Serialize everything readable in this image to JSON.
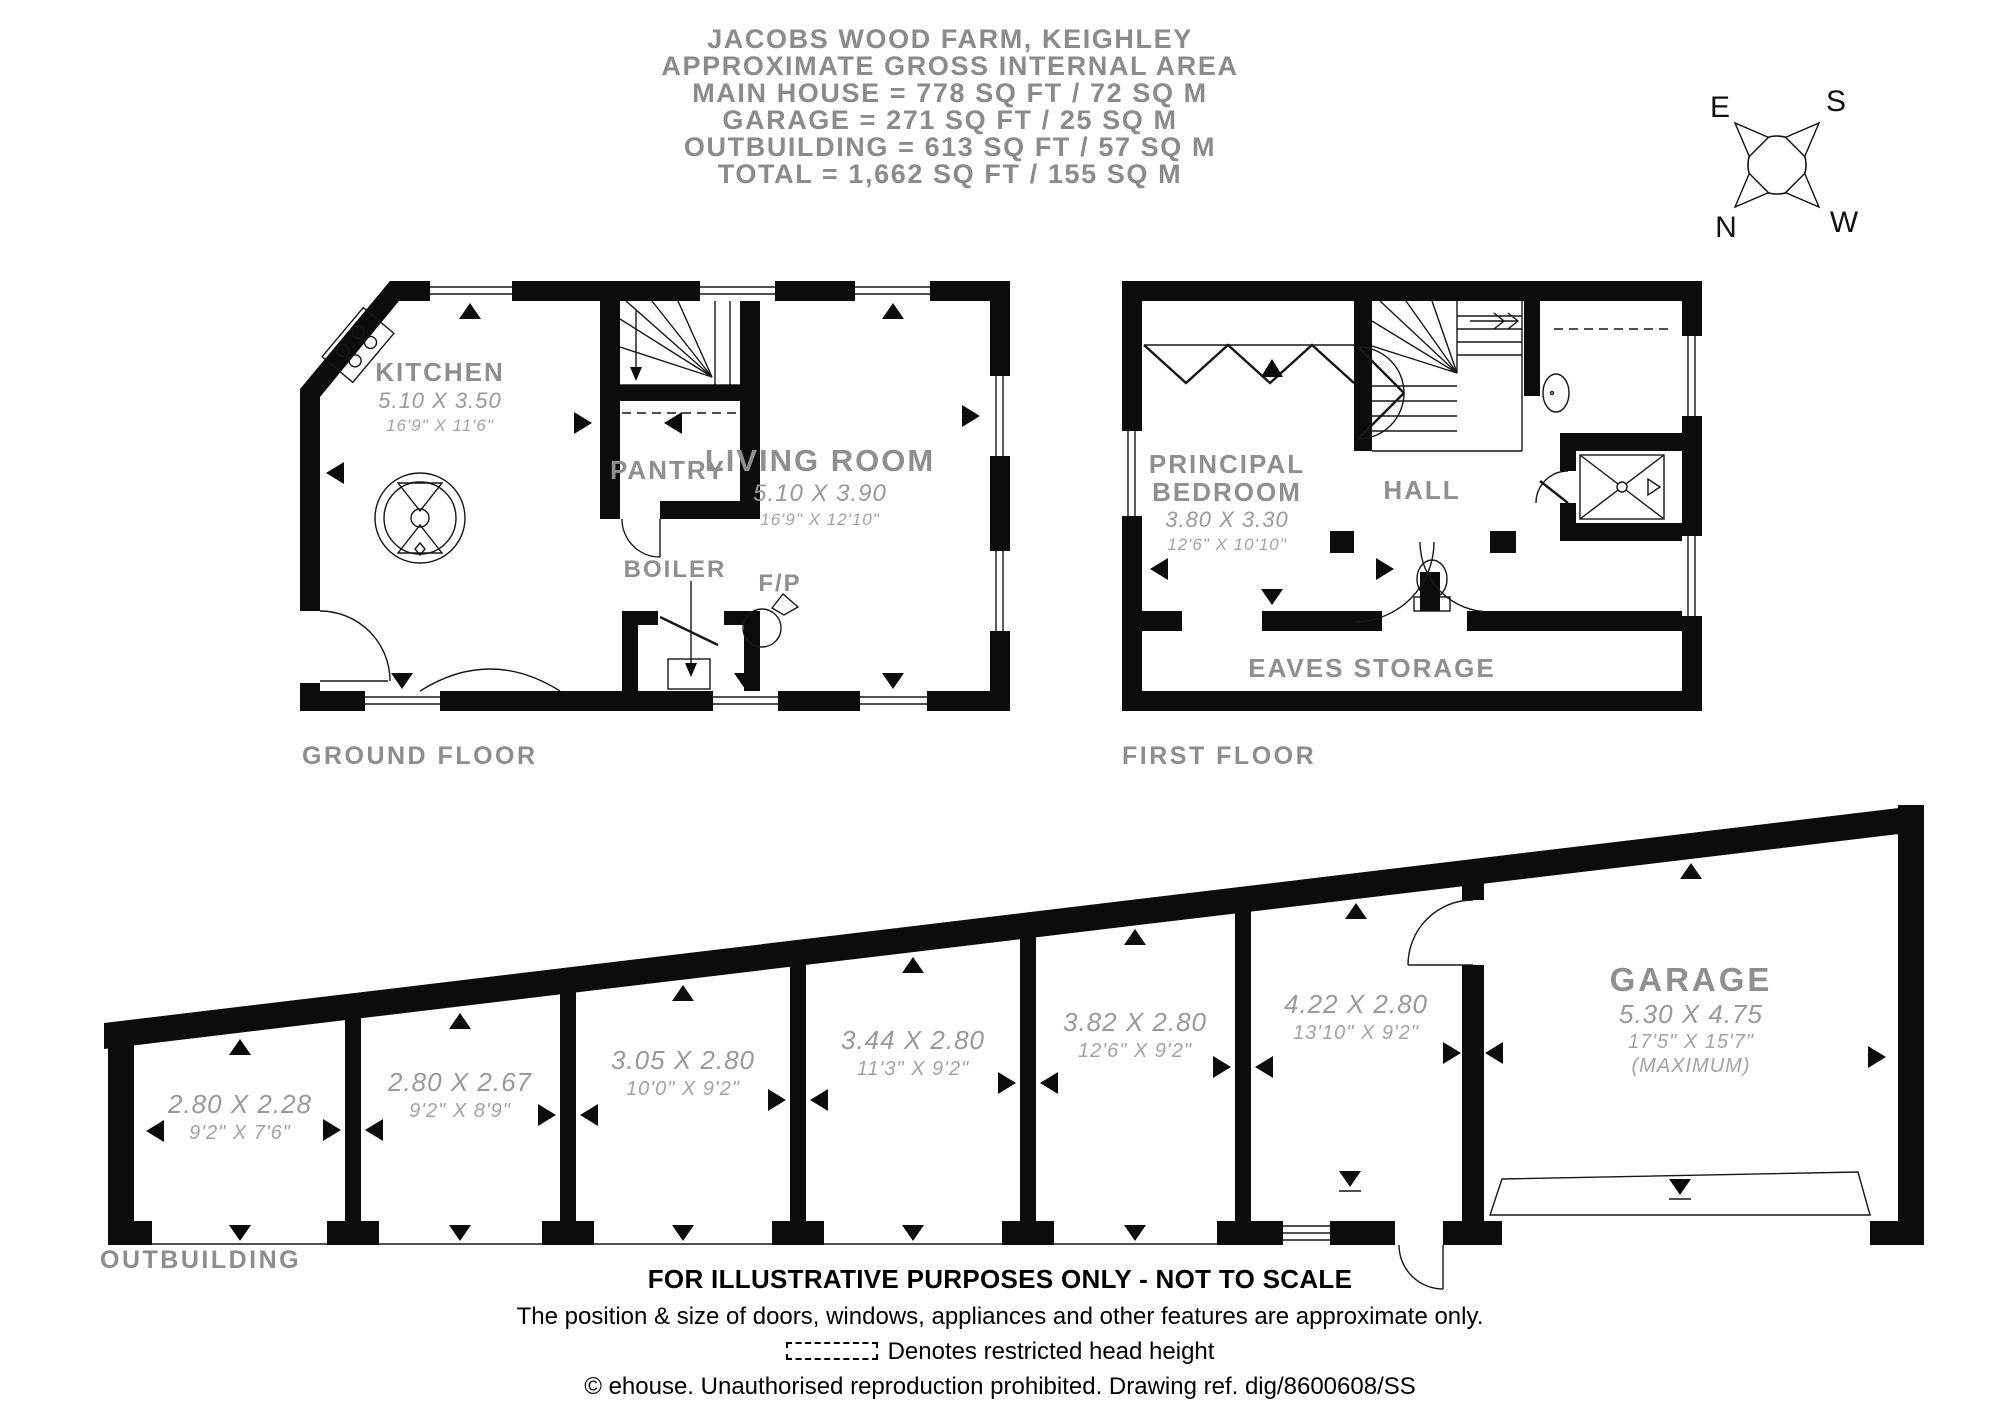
{
  "header": {
    "lines": [
      "JACOBS WOOD FARM, KEIGHLEY",
      "APPROXIMATE GROSS INTERNAL AREA",
      "MAIN HOUSE = 778 SQ FT / 72 SQ M",
      "GARAGE = 271 SQ FT / 25 SQ M",
      "OUTBUILDING = 613 SQ FT / 57 SQ M",
      "TOTAL = 1,662 SQ FT / 155 SQ M"
    ]
  },
  "compass": {
    "east": "E",
    "south": "S",
    "north": "N",
    "west": "W"
  },
  "ground_floor": {
    "title": "GROUND FLOOR",
    "kitchen": {
      "name": "KITCHEN",
      "metric": "5.10 X 3.50",
      "imperial": "16'9\" X 11'6\""
    },
    "pantry": {
      "name": "PANTRY"
    },
    "living_room": {
      "name": "LIVING ROOM",
      "metric": "5.10 X 3.90",
      "imperial": "16'9\" X 12'10\""
    },
    "boiler": {
      "name": "BOILER"
    },
    "fireplace": {
      "name": "F/P"
    }
  },
  "first_floor": {
    "title": "FIRST FLOOR",
    "principal_bedroom": {
      "line1": "PRINCIPAL",
      "line2": "BEDROOM",
      "metric": "3.80 X 3.30",
      "imperial": "12'6\" X 10'10\""
    },
    "hall": {
      "name": "HALL"
    },
    "eaves": {
      "name": "EAVES STORAGE"
    }
  },
  "outbuilding": {
    "title": "OUTBUILDING",
    "rooms": [
      {
        "metric": "2.80 X 2.28",
        "imperial": "9'2\" X 7'6\""
      },
      {
        "metric": "2.80 X 2.67",
        "imperial": "9'2\" X 8'9\""
      },
      {
        "metric": "3.05 X 2.80",
        "imperial": "10'0\" X 9'2\""
      },
      {
        "metric": "3.44 X 2.80",
        "imperial": "11'3\" X 9'2\""
      },
      {
        "metric": "3.82 X 2.80",
        "imperial": "12'6\" X 9'2\""
      },
      {
        "metric": "4.22 X 2.80",
        "imperial": "13'10\" X 9'2\""
      }
    ],
    "garage": {
      "name": "GARAGE",
      "metric": "5.30 X 4.75",
      "imperial": "17'5\" X 15'7\"",
      "note": "(MAXIMUM)"
    }
  },
  "footer": {
    "line1": "FOR ILLUSTRATIVE PURPOSES ONLY - NOT TO SCALE",
    "line2": "The position & size of doors, windows, appliances and other features are approximate only.",
    "legend": "Denotes restricted head height",
    "line4": "© ehouse. Unauthorised reproduction prohibited. Drawing ref. dig/8600608/SS"
  }
}
